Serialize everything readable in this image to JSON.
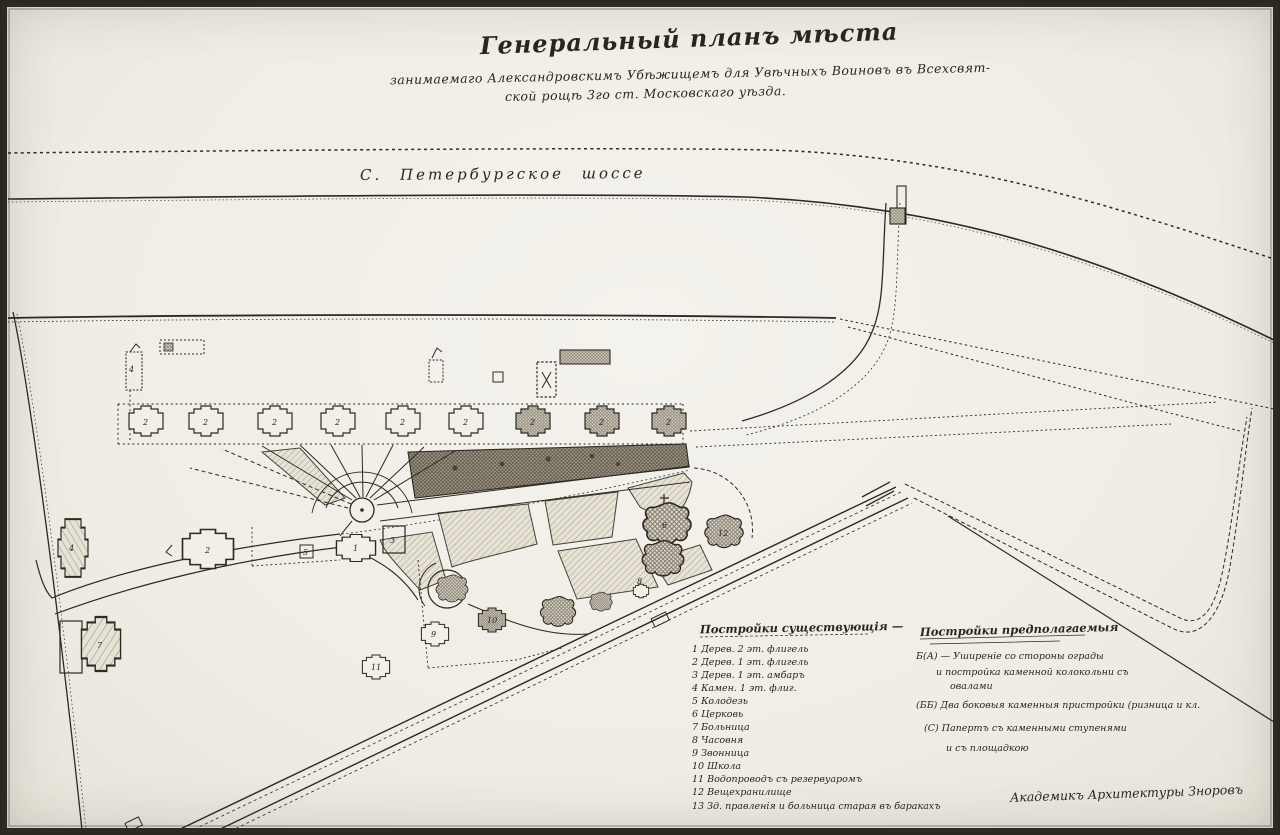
{
  "title": {
    "line1": "Генеральный планъ мѣста",
    "line2": "занимаемаго Александровскимъ Убѣжищемъ для Увѣчныхъ Воиновъ въ Всехсвят-",
    "line3": "ской рощѣ 3го ст. Московскаго уѣзда."
  },
  "road_label": "С. Петербургское шоссе",
  "legend_existing": {
    "title": "Постройки существующія —",
    "items": [
      "1  Дерев. 2 эт. флигель",
      "2  Дерев. 1 эт. флигель",
      "3  Дерев. 1 эт. амбаръ",
      "4  Камен. 1 эт. флиг.",
      "5  Колодезь",
      "6  Церковь",
      "7  Больница",
      "8  Часовня",
      "9  Звонница",
      "10  Школа",
      "11  Водопроводъ съ резервуаромъ",
      "12  Вещехранилище",
      "13  Зд. правленія и больница старая въ баракахъ"
    ]
  },
  "legend_proposed": {
    "title": "Постройки предполагаемыя",
    "lines": [
      "Б(А) — Уширеніе со стороны ограды",
      "и постройка каменной колокольни съ",
      "овалами",
      "(ББ)  Два боковыя каменныя пристройки (ризница и кл.",
      "(С)  Папертъ съ каменными ступенями",
      "и съ площадкою"
    ]
  },
  "signature": "Академикъ Архитектуры Зноровъ",
  "map_labels": {
    "row_building": "2",
    "main_building": "1",
    "store_building": "3",
    "west_building": "2",
    "tall_building": "4",
    "hospital_complex": "7",
    "well": "5",
    "church": "6",
    "chapel": "8",
    "bell": "9",
    "school": "10",
    "water": "11",
    "shed": "12",
    "nw_flag": "4"
  },
  "colors": {
    "paper": "#f1efe8",
    "ink": "#2e2a23",
    "hatch_light": "#a89f8e",
    "hatch_dark": "#6f675a",
    "bed_dark_bg": "#a59c8b"
  }
}
